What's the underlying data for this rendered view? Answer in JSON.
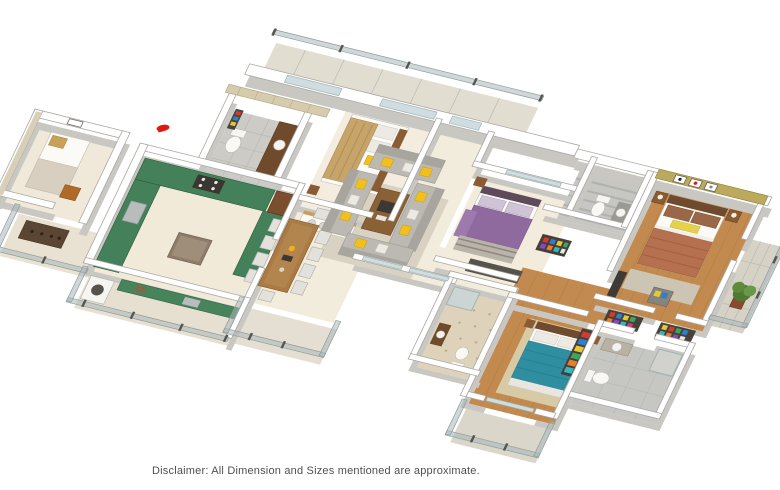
{
  "meta": {
    "kind": "3d-isometric-floor-plan-render",
    "background": "#ffffff",
    "width": 780,
    "height": 490
  },
  "disclaimer": "Disclaimer: All Dimension and Sizes mentioned are approximate.",
  "marker": {
    "name": "red-location-marker",
    "color": "#e0190e"
  },
  "palette": {
    "wall_white": "#ffffff",
    "wall_shadow": "#c9c7c2",
    "wall_olive_accent": "#bba95e",
    "wall_stone_accent": "#d7cbae",
    "floor_cream": "#f2ecdc",
    "floor_wood": "#c28a4e",
    "floor_gray_tile": "#cbcbc7",
    "floor_pattern_tile": "#ded3ba",
    "balcony_floor": "#d9d5c9",
    "glass_railing": "#a8b6b8",
    "counter_green_granite": "#44815a",
    "accent_yellow": "#f1c01d",
    "sofa_gray": "#bcb9b3",
    "bed_teal": "#2f8fa0",
    "bed_terracotta": "#b5714f",
    "bed_purple": "#8e6a9e",
    "bed_tan_striped": "#c7a469",
    "dark_wood": "#6f4a2c"
  },
  "rooms": [
    {
      "id": "servant-room",
      "floor": "cream",
      "items": [
        "single-bed",
        "wall-art",
        "accent-wall",
        "chair"
      ]
    },
    {
      "id": "entrance-foyer",
      "floor": "tile",
      "items": [
        "shoe-cabinet",
        "glass-railing"
      ]
    },
    {
      "id": "powder-bathroom",
      "floor": "gray-tile",
      "items": [
        "toilet",
        "washbasin",
        "stone-accent-wall"
      ]
    },
    {
      "id": "kitchen",
      "floor": "cream",
      "items": [
        "u-shaped-green-granite-counter",
        "cooktop",
        "sink",
        "island",
        "breakfast-bar",
        "three-yellow-bar-stools",
        "refrigerator"
      ]
    },
    {
      "id": "utility-balcony",
      "floor": "cream",
      "items": [
        "washing-machine",
        "green-counter",
        "glass-railing"
      ]
    },
    {
      "id": "dining-area",
      "floor": "cream",
      "items": [
        "wooden-dining-table",
        "upholstered-chairs",
        "crockery-sideboard",
        "balcony"
      ]
    },
    {
      "id": "living-room",
      "floor": "cream",
      "items": [
        "u-shaped-gray-sofa-set",
        "yellow-accent-pillows",
        "wooden-coffee-table",
        "area-rug"
      ]
    },
    {
      "id": "bedroom-1",
      "floor": "cream",
      "items": [
        "double-bed-tan-striped",
        "yellow-cushions",
        "side-tables"
      ]
    },
    {
      "id": "bedroom-2",
      "floor": "cream",
      "items": [
        "double-bed-purple",
        "rug",
        "nightstand",
        "open-wardrobe"
      ]
    },
    {
      "id": "bathroom-2",
      "floor": "striped-gray-tile",
      "items": [
        "toilet",
        "washbasin",
        "shower"
      ]
    },
    {
      "id": "bedroom-3",
      "floor": "wood",
      "items": [
        "double-bed-teal",
        "rug",
        "side-tables",
        "open-wardrobe",
        "front-balcony"
      ]
    },
    {
      "id": "bathroom-3",
      "floor": "patterned-tile",
      "items": [
        "toilet",
        "washbasin",
        "shower",
        "mosaic-accent-wall"
      ]
    },
    {
      "id": "master-bedroom",
      "floor": "wood",
      "items": [
        "double-bed-terracotta",
        "olive-accent-wall",
        "three-framed-artworks",
        "nightstands-with-lamps",
        "armchair",
        "tv-console",
        "open-wardrobes"
      ]
    },
    {
      "id": "master-bathroom",
      "floor": "gray-tile",
      "items": [
        "toilet",
        "washbasin",
        "shower"
      ]
    },
    {
      "id": "master-balcony",
      "floor": "gray-tile",
      "items": [
        "potted-plant",
        "glass-railing"
      ]
    },
    {
      "id": "rear-balcony",
      "floor": "tile",
      "items": [
        "glass-railing"
      ]
    }
  ]
}
